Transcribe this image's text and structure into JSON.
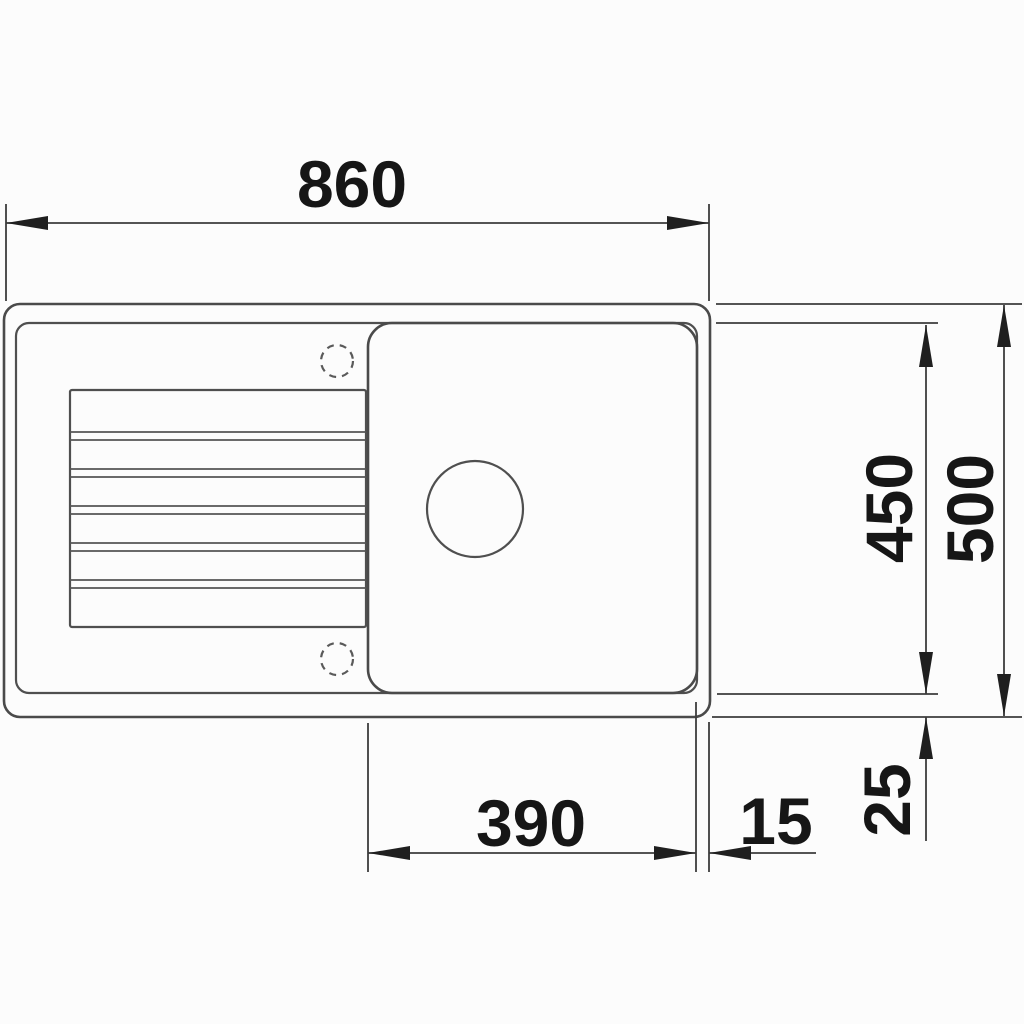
{
  "drawing": {
    "type": "technical-dimension-drawing",
    "subject": "kitchen sink with drainboard, top view",
    "dimensions": {
      "total_width": "860",
      "total_depth": "500",
      "inner_depth": "450",
      "bowl_width": "390",
      "bowl_to_edge_gap": "15",
      "rim_to_edge_gap": "25"
    },
    "colors": {
      "background": "#fcfcfc",
      "outline": "#4a4a4a",
      "dimension_line": "#3c3c3c",
      "arrow": "#1f1f1f",
      "text": "#161616"
    }
  }
}
